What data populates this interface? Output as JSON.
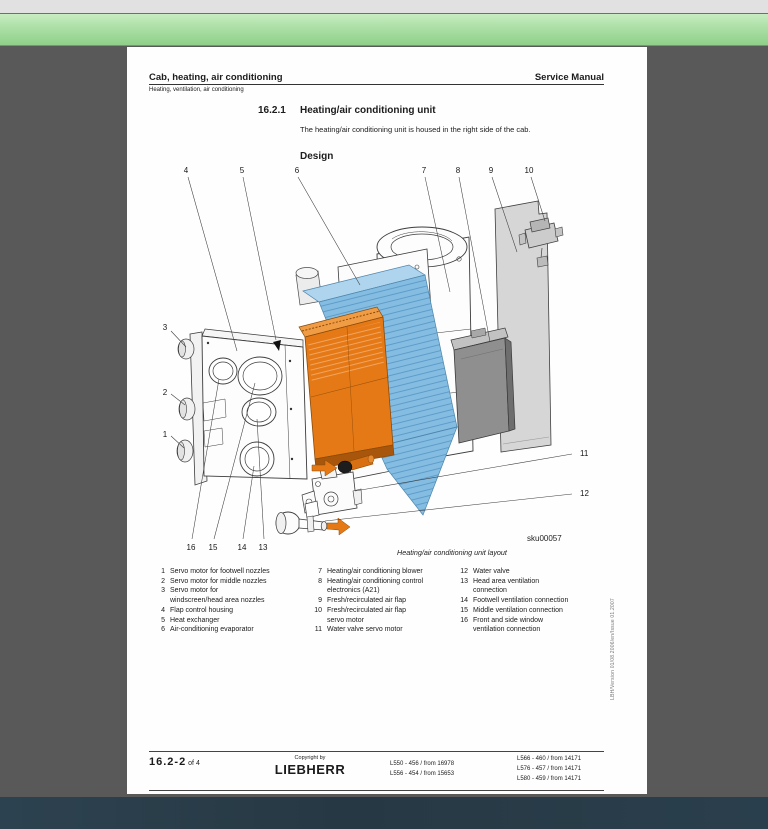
{
  "window": {
    "top_bar_color": "#e1e1e1",
    "toolbar_green_top": "#c8ecc2",
    "toolbar_green_bottom": "#8fd08a",
    "canvas_color": "#595959",
    "bottom_bar_color": "#283b47"
  },
  "page": {
    "header": {
      "title": "Cab, heating, air conditioning",
      "manual": "Service Manual",
      "subtitle": "Heating, ventilation, air conditioning"
    },
    "section": {
      "number": "16.2.1",
      "title": "Heating/air conditioning unit",
      "intro": "The heating/air conditioning unit is housed in the right side of the cab.",
      "design": "Design"
    },
    "figure": {
      "caption": "Heating/air conditioning unit layout",
      "code": "sku00057",
      "callouts": {
        "n1": "1",
        "n2": "2",
        "n3": "3",
        "n4": "4",
        "n5": "5",
        "n6": "6",
        "n7": "7",
        "n8": "8",
        "n9": "9",
        "n10": "10",
        "n11": "11",
        "n12": "12",
        "n13": "13",
        "n14": "14",
        "n15": "15",
        "n16": "16"
      }
    },
    "diagram_colors": {
      "heat_exchanger_orange": "#e57916",
      "evaporator_blue": "#85bde2",
      "panel_gray": "#d6d6d6",
      "electronics_gray": "#8f8f8f",
      "arrow_orange": "#e57916"
    },
    "legend": {
      "col1": [
        {
          "n": "1",
          "t": "Servo motor for footwell nozzles"
        },
        {
          "n": "2",
          "t": "Servo motor for middle nozzles"
        },
        {
          "n": "3",
          "t": "Servo motor for\nwindscreen/head area nozzles"
        },
        {
          "n": "4",
          "t": "Flap control housing"
        },
        {
          "n": "5",
          "t": "Heat exchanger"
        },
        {
          "n": "6",
          "t": "Air-conditioning evaporator"
        }
      ],
      "col2": [
        {
          "n": "7",
          "t": "Heating/air conditioning blower"
        },
        {
          "n": "8",
          "t": "Heating/air conditioning control\nelectronics (A21)"
        },
        {
          "n": "9",
          "t": "Fresh/recirculated air flap"
        },
        {
          "n": "10",
          "t": "Fresh/recirculated air flap\nservo motor"
        },
        {
          "n": "11",
          "t": "Water valve servo motor"
        }
      ],
      "col3": [
        {
          "n": "12",
          "t": "Water valve"
        },
        {
          "n": "13",
          "t": "Head area ventilation\nconnection"
        },
        {
          "n": "14",
          "t": "Footwell ventilation connection"
        },
        {
          "n": "15",
          "t": "Middle ventilation connection"
        },
        {
          "n": "16",
          "t": "Front and side window\nventilation connection"
        }
      ]
    },
    "footer": {
      "page_number": "16.2-2",
      "page_of": "of 4",
      "copyright": "Copyright by",
      "brand": "LIEBHERR",
      "models_left": [
        "L550 - 456 / from 16978",
        "L556 - 454 / from 15653"
      ],
      "models_right": [
        "L566 - 460 / from 14171",
        "L576 - 457 / from 14171",
        "L580 - 459 / from 14171"
      ]
    },
    "side_note": "LBH/Version 01/08.2006/en/Issue 01.2007"
  }
}
